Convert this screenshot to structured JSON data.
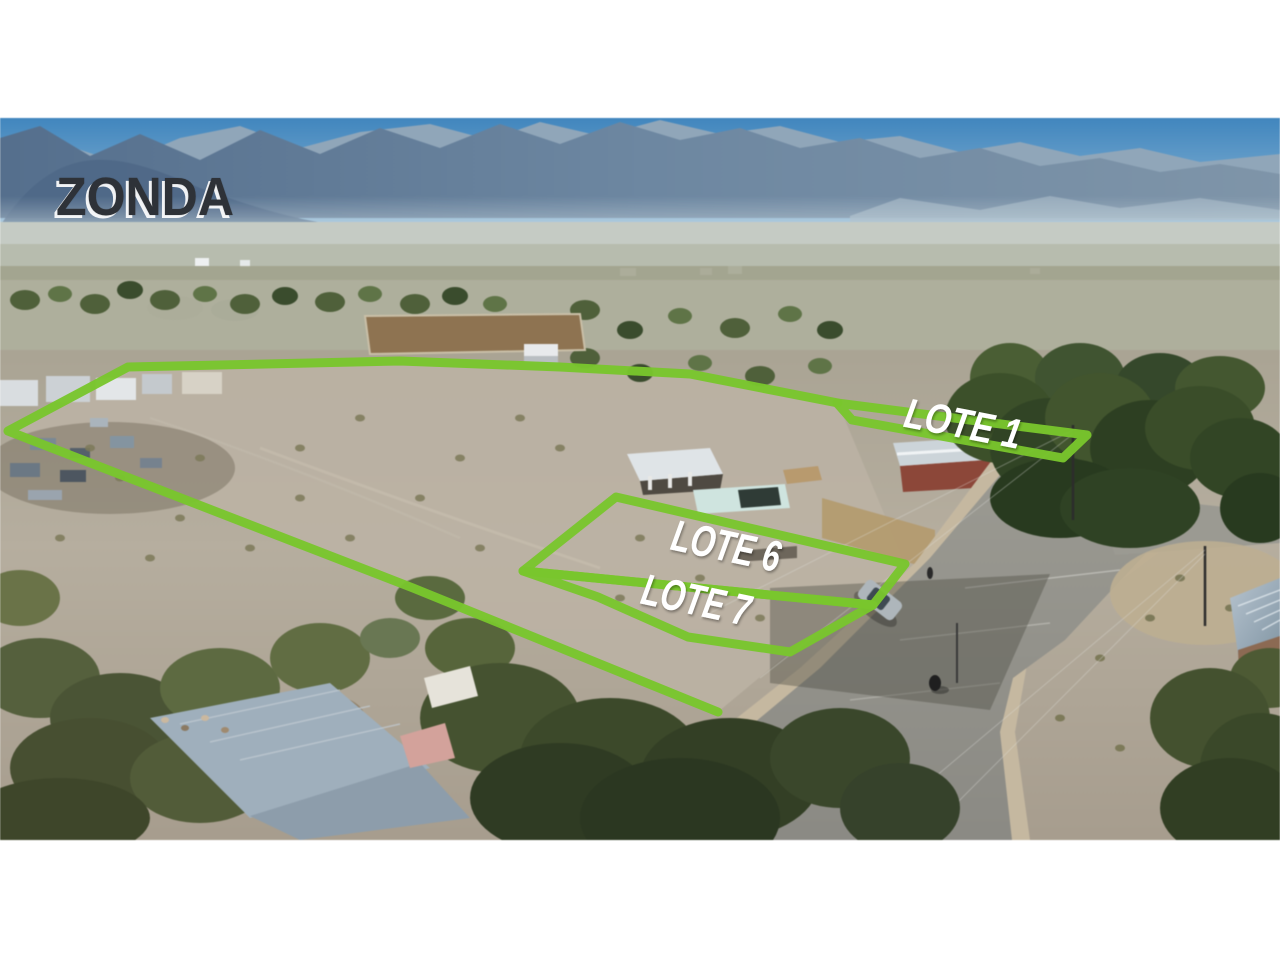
{
  "watermark": {
    "text": "ZONDA"
  },
  "lots": [
    {
      "id": "lote-1",
      "label": "LOTE 1"
    },
    {
      "id": "lote-6",
      "label": "LOTE 6"
    },
    {
      "id": "lote-7",
      "label": "LOTE 7"
    }
  ],
  "colors": {
    "lot_outline": "#79c62d",
    "lot_label_text": "#ffffff",
    "watermark_text": "#2e3237",
    "watermark_shadow": "#ffffff",
    "sky": "#4187c0",
    "mountains": "#64809d",
    "field_dirt": "#b6ae9f",
    "road": "#95948c",
    "letterbox": "#ffffff"
  }
}
